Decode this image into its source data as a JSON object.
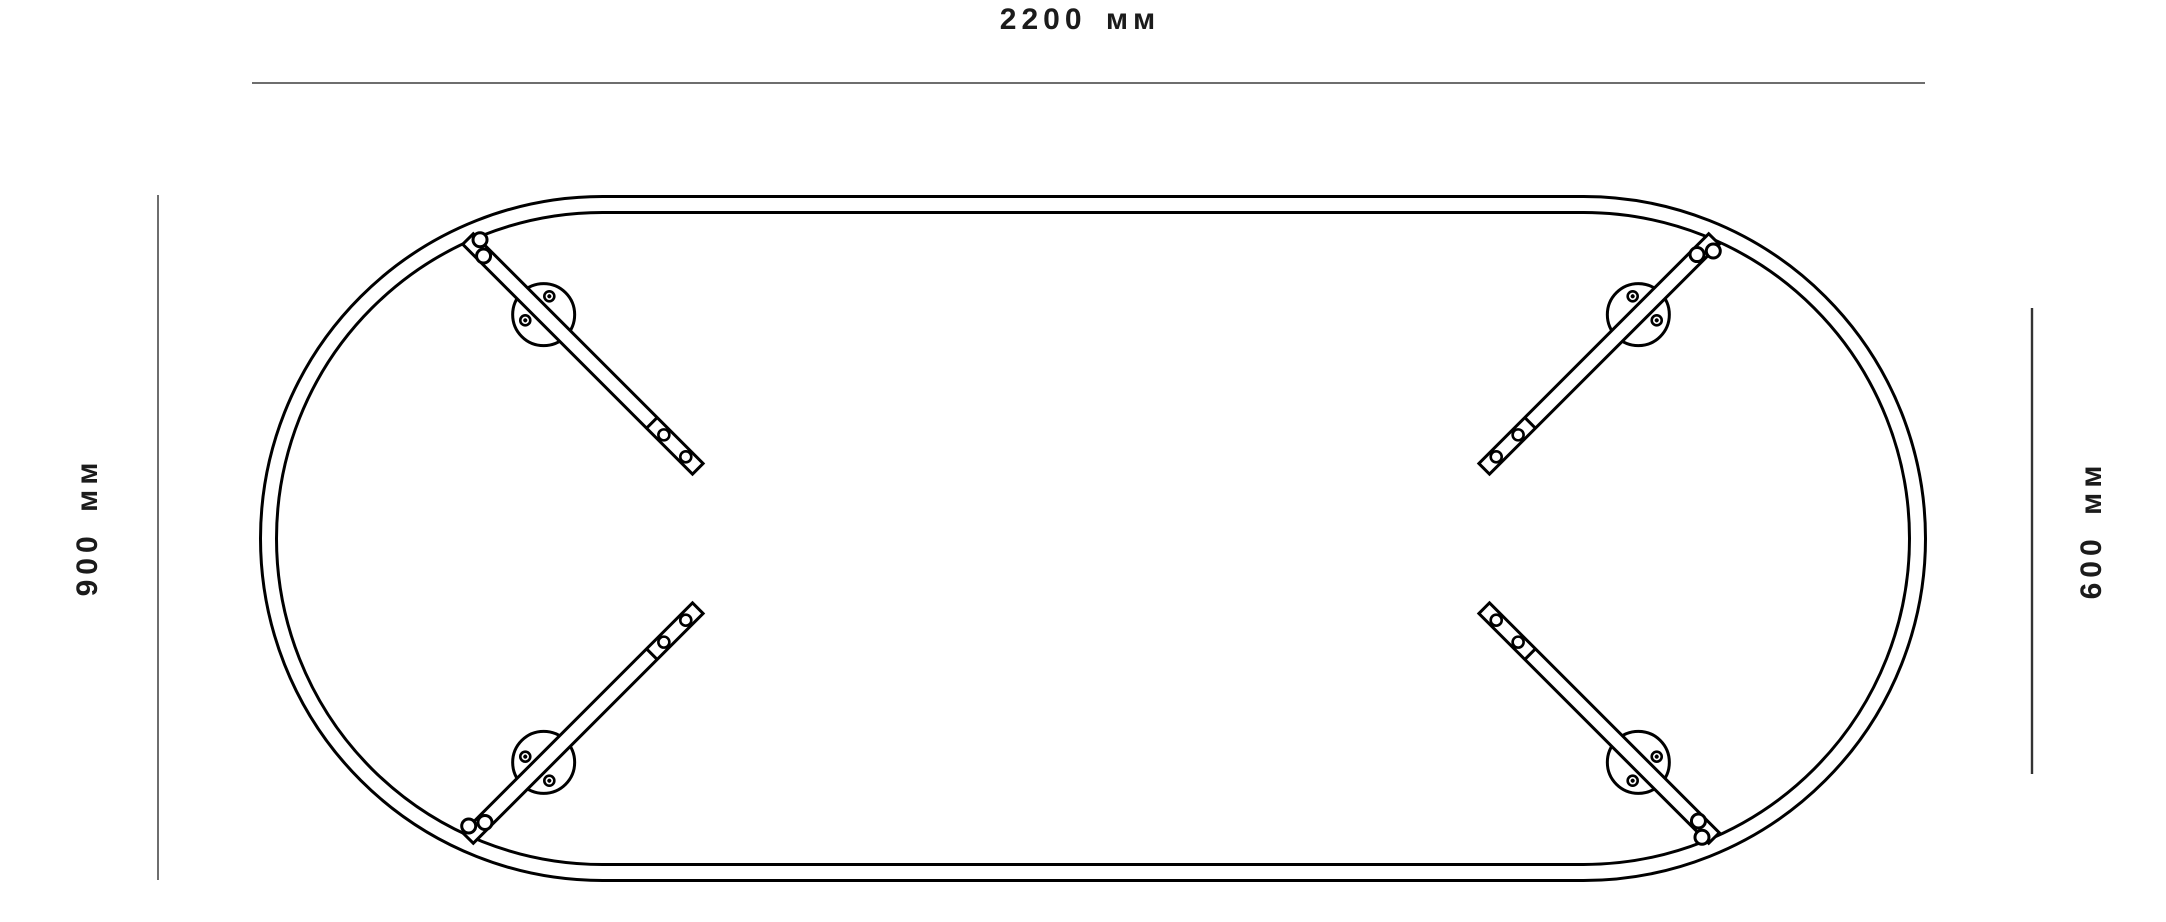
{
  "page": {
    "background_color": "#ffffff"
  },
  "drawing": {
    "ink_color": "#000000",
    "dimension_line_color": "#6e6e6e",
    "dimensions": {
      "width": {
        "label": "2200 мм",
        "value_mm": 2200,
        "side": "top"
      },
      "left_depth": {
        "label": "900 мм",
        "value_mm": 900,
        "side": "left"
      },
      "right_depth": {
        "label": "600 мм",
        "value_mm": 600,
        "side": "right"
      }
    },
    "parts": {
      "tabletop": "oval-tabletop-double-outline",
      "legs": [
        "leg-bracket-top-left",
        "leg-bracket-top-right",
        "leg-bracket-bottom-left",
        "leg-bracket-bottom-right"
      ]
    }
  }
}
